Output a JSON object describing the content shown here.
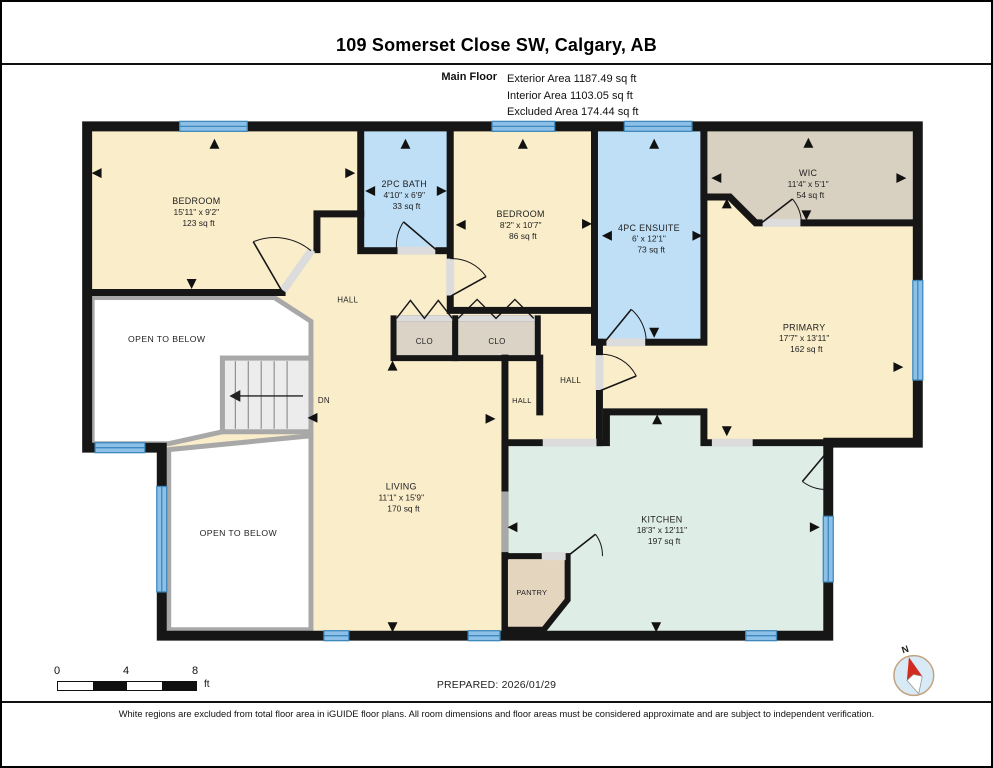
{
  "header": {
    "title": "109 Somerset Close SW, Calgary, AB",
    "floor_label": "Main Floor",
    "area_lines": [
      "Exterior Area 1187.49 sq ft",
      "Interior Area 1103.05 sq ft",
      "Excluded Area 174.44 sq ft"
    ]
  },
  "rooms": [
    {
      "name": "BEDROOM",
      "dims": "15'11\" x 9'2\"",
      "area": "123 sq ft"
    },
    {
      "name": "2PC BATH",
      "dims": "4'10\" x 6'9\"",
      "area": "33 sq ft"
    },
    {
      "name": "BEDROOM",
      "dims": "8'2\" x 10'7\"",
      "area": "86 sq ft"
    },
    {
      "name": "4PC ENSUITE",
      "dims": "6' x 12'1\"",
      "area": "73 sq ft"
    },
    {
      "name": "WIC",
      "dims": "11'4\" x 5'1\"",
      "area": "54 sq ft"
    },
    {
      "name": "PRIMARY",
      "dims": "17'7\" x 13'11\"",
      "area": "162 sq ft"
    },
    {
      "name": "LIVING",
      "dims": "11'1\" x 15'9\"",
      "area": "170 sq ft"
    },
    {
      "name": "KITCHEN",
      "dims": "18'3\" x 12'11\"",
      "area": "197 sq ft"
    }
  ],
  "labels": {
    "hall": "HALL",
    "closet": "CLO",
    "pantry": "PANTRY",
    "down": "DN",
    "open_to_below": "OPEN TO BELOW",
    "north": "N"
  },
  "footer": {
    "scale_ticks": [
      "0",
      "4",
      "8"
    ],
    "scale_unit": "ft",
    "prepared": "PREPARED: 2026/01/29",
    "disclaimer": "White regions are excluded from total floor area in iGUIDE floor plans. All room dimensions and floor areas must be considered approximate and are subject to independent verification."
  },
  "colors": {
    "room_cream": "#FAEDCA",
    "room_blue": "#BEDFF6",
    "room_tan": "#D8D0C1",
    "room_closet": "#DBD4C6",
    "room_kitchen": "#DFEDE7",
    "room_pantry": "#E4D5BF",
    "window_fill": "#8CC0E8",
    "window_stroke": "#3E88BC",
    "wall": "#161616"
  }
}
